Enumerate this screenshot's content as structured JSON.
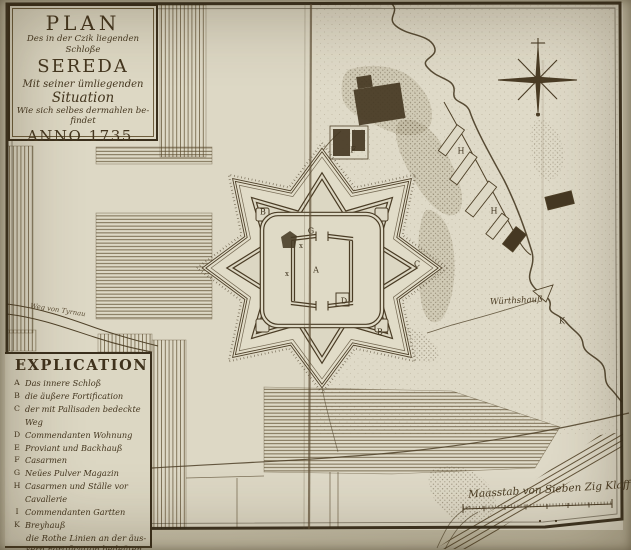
{
  "cartouche": {
    "lines": [
      "PLAN",
      "Des in der Czik liegenden Schloße",
      "SEREDA",
      "Mit seiner ümliegenden",
      "Situation",
      "Wie sich selbes dermahlen be-",
      "findet",
      "ANNO 1735."
    ]
  },
  "explication": {
    "heading": "EXPLICATION",
    "items": [
      {
        "letter": "A",
        "text": "Das innere Schloß"
      },
      {
        "letter": "B",
        "text": "die äußere Fortification"
      },
      {
        "letter": "C",
        "text": "der mit Pallisaden bedeckte Weg"
      },
      {
        "letter": "D",
        "text": "Commendanten Wohnung"
      },
      {
        "letter": "E",
        "text": "Proviant und Backhauß"
      },
      {
        "letter": "F",
        "text": "Casarmen"
      },
      {
        "letter": "G",
        "text": "Neües Pulver Magazin"
      },
      {
        "letter": "H",
        "text": "Casarmen und Ställe vor Cavallerie"
      },
      {
        "letter": "I",
        "text": "Commendanten Gartten"
      },
      {
        "letter": "K",
        "text": "Breyhauß"
      }
    ],
    "note": [
      "die Rothe Linien an der äus-",
      "sern Fortification bedeüten die",
      "neüe gemaurte Escarpe &"
    ]
  },
  "scale_bar": {
    "label": "Maasstab von Sieben Zig Klafftern"
  },
  "labels": {
    "road_west": "Weg von Tyrnau",
    "inn": "Würthshauß"
  },
  "letters": [
    {
      "ch": "A"
    },
    {
      "ch": "B"
    },
    {
      "ch": "B"
    },
    {
      "ch": "C"
    },
    {
      "ch": "D"
    },
    {
      "ch": "G"
    },
    {
      "ch": "H"
    },
    {
      "ch": "H"
    },
    {
      "ch": "K"
    },
    {
      "ch": "F"
    },
    {
      "ch": "x"
    },
    {
      "ch": "x"
    }
  ],
  "colors": {
    "ink": "#44361f",
    "paper": "#ddd8c5",
    "dark_building": "#453823"
  }
}
